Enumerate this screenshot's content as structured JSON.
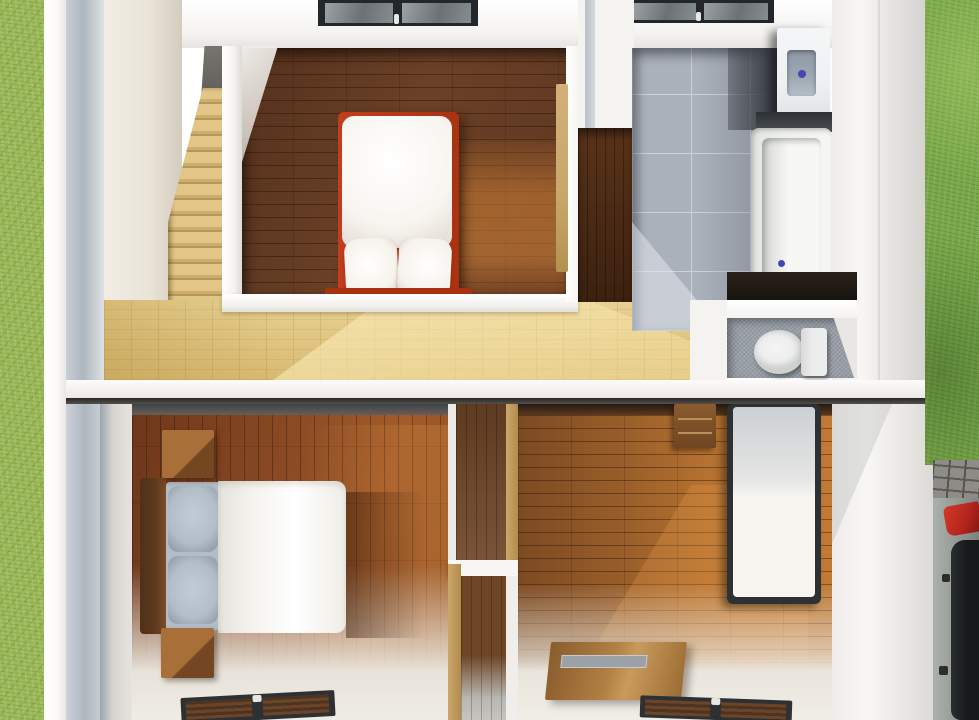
{
  "scene": {
    "view": "top-down cutaway 3D architectural render",
    "setting": "two-storey small house interior seen from above, lawn strips on both sides, paved driveway with a parked car at lower right",
    "floors": [
      {
        "name": "upper floor",
        "rooms": [
          {
            "name": "staircase",
            "items": [
              "light wooden stairs",
              "stair landing"
            ]
          },
          {
            "name": "bedroom",
            "items": [
              "double bed with red frame and white mattress",
              "two white pillows",
              "dark hardwood plank floor",
              "skylight window",
              "wooden door"
            ]
          },
          {
            "name": "hallway",
            "items": [
              "light oak floor",
              "sunlight patch"
            ]
          },
          {
            "name": "bathroom",
            "items": [
              "gray tile floor",
              "washing machine",
              "bathtub",
              "skylight window"
            ]
          },
          {
            "name": "wc",
            "items": [
              "toilet with tank",
              "gray tile floor",
              "dark storage opening"
            ]
          }
        ]
      },
      {
        "name": "lower floor",
        "rooms": [
          {
            "name": "bedroom-left",
            "items": [
              "double bed with wooden headboard, gray pillows and white duvet",
              "two wooden nightstands",
              "vertical plank hardwood floor",
              "window in bottom wall"
            ]
          },
          {
            "name": "closet",
            "items": [
              "built-in wardrobe with shelf and wooden interior"
            ]
          },
          {
            "name": "bedroom-right",
            "items": [
              "single bed with white mattress",
              "wooden desk",
              "wooden table with gray tray",
              "horizontal plank hardwood floor",
              "window in bottom wall"
            ]
          }
        ]
      }
    ],
    "exterior": {
      "left": "lawn strip",
      "right": [
        "lawn strip",
        "cobblestone driveway",
        "parked gray car with red taillight"
      ]
    }
  },
  "colors": {
    "grass-left": "#9cba58",
    "grass-right": "#79a848",
    "wall-white": "#f5f3f0",
    "wall-bright": "#fbfaf8",
    "wall-shadow": "#d9d6d1",
    "wall-gray-blue": "#aeb6bf",
    "wall-cream": "#e9e3d8",
    "ceiling": "#f4f3f0",
    "wood-dark-1": "#53301c",
    "wood-dark-2": "#6b4126",
    "wood-sun": "#b5722f",
    "closet-wood": "#4a2a16",
    "hall-tan-1": "#d9ba72",
    "hall-tan-2": "#e8d191",
    "hall-sun": "#f6e9b8",
    "stair-step": "#e2c687",
    "stair-shadow": "#b8965a",
    "tile-gray": "#aab0ba",
    "tile-grout": "#ced3d9",
    "tile-dark": "#383c42",
    "wc-tile": "#9aa0a8",
    "bed-red": "#c23d1d",
    "bed-red-dark": "#a93311",
    "mattress-white": "#f8f5f0",
    "pillow-white": "#f6f2ec",
    "duvet-white": "#f3f2ed",
    "pillow-gray": "#b3bdc8",
    "headboard-wood": "#5e3a1e",
    "nightstand-wood": "#9a6434",
    "nightstand-dark": "#744722",
    "floor2-left-1": "#6e371b",
    "floor2-left-2": "#a35c2b",
    "floor2-right-1": "#7c4a22",
    "floor2-right-2": "#c07a36",
    "floor-washed": "#ece8e0",
    "frame-dark": "#2e3134",
    "glass-brown": "#6b452a",
    "desk-wood": "#8a5c2e",
    "table-wood": "#b07f42",
    "tray-gray": "#9aa2a8",
    "washer-white": "#eef1f2",
    "washer-lid": "#9ba6b2",
    "appliance-dot-blue": "#4547b0",
    "tub-white": "#eef0ee",
    "tub-inner": "#f7f7f3",
    "toilet-white": "#eceded",
    "paver-gray": "#8e8c86",
    "paver-joint": "#56544e",
    "car-body": "#979d98",
    "car-dark": "#17191b",
    "car-red": "#b5251c",
    "divider-shadow": "#2a2826",
    "skylight-frame": "#23262a",
    "skylight-glass-1": "#9aa2a6",
    "skylight-glass-2": "#6a7276"
  }
}
